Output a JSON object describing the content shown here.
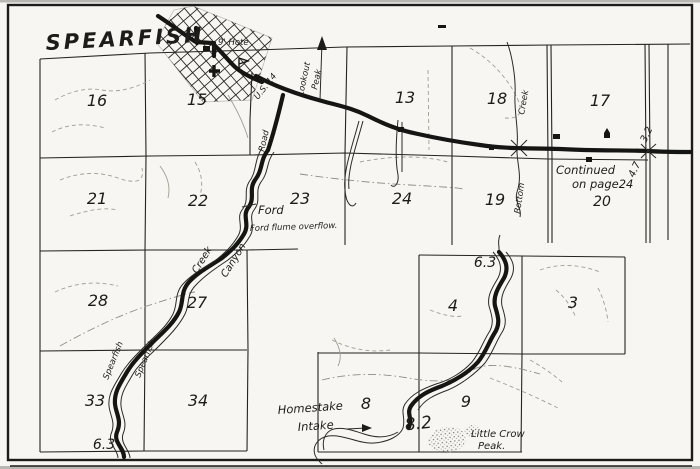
{
  "title": "SPEARFISH",
  "sections": {
    "s16": "16",
    "s15": "15",
    "s13": "13",
    "s18": "18",
    "s17": "17",
    "s21": "21",
    "s22": "22",
    "s23": "23",
    "s24": "24",
    "s19": "19",
    "s20": "20",
    "s28": "28",
    "s27": "27",
    "s33": "33",
    "s34": "34",
    "s4": "4",
    "s3": "3",
    "s8": "8",
    "s9": "9"
  },
  "roads": {
    "highway": "U.S. 14",
    "road": "Road"
  },
  "peaks": {
    "lookout_line1": "Lookout",
    "lookout_line2": "Peak",
    "little_crow_line1": "Little Crow",
    "little_crow_line2": "Peak."
  },
  "creeks": {
    "spearfish_creek": "Spearfish",
    "creek": "Creek",
    "spearfish_canyon": "Spearfish",
    "canyon": "Canyon",
    "false_bottom_upper": "Creek",
    "false_bottom_lower": "Bottom"
  },
  "notes": {
    "continued_line1": "Continued",
    "continued_line2": "on page24",
    "hotel": "9' Hote",
    "ford": "Ford",
    "ford_flume": "Ford flume overflow.",
    "homestake_line1": "Homestake",
    "homestake_line2": "Intake"
  },
  "mileages": {
    "east_above_road": "3.2",
    "east_below_road": "4.7",
    "creek_north": "6.3",
    "creek_south": "6.3",
    "intake": "8.2"
  },
  "colors": {
    "ink": "#1d1c1a",
    "paper": "#faf9f5",
    "light": "#a09e92"
  }
}
